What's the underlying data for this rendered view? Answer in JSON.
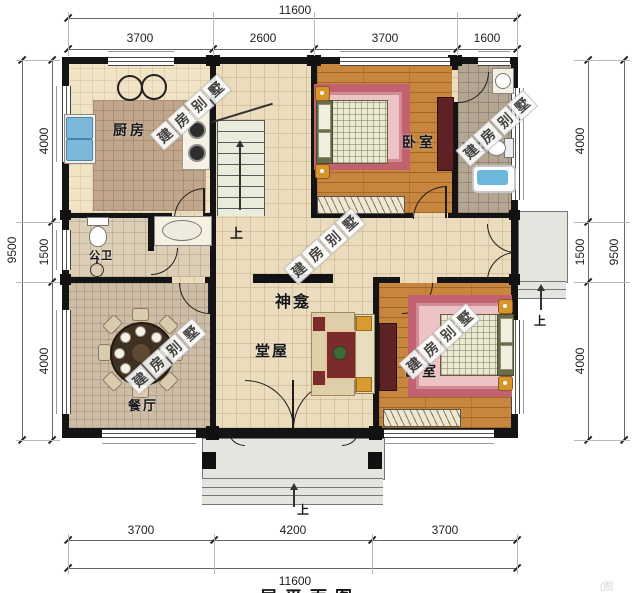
{
  "drawing": {
    "type": "floor-plan",
    "footer": {
      "partial_title": "一层平面图",
      "corner_fragment": "(图"
    }
  },
  "watermark": {
    "text": "建房别墅",
    "chars": [
      "建",
      "房",
      "别",
      "墅"
    ]
  },
  "dimensions": {
    "top": {
      "total": "11600",
      "segments": [
        "3700",
        "2600",
        "3700",
        "1600"
      ]
    },
    "bottom": {
      "total": "11600",
      "segments": [
        "3700",
        "4200",
        "3700"
      ]
    },
    "left": {
      "total": "9500",
      "segments": [
        "4000",
        "1500",
        "4000"
      ]
    },
    "right": {
      "total": "9500",
      "segments": [
        "4000",
        "1500",
        "4000"
      ]
    }
  },
  "rooms": {
    "kitchen": "厨房",
    "bedroom_top": "卧室",
    "private_bath": "私卫",
    "public_bath": "公卫",
    "dining": "餐厅",
    "hall": "堂屋",
    "shrine": "神龛",
    "bedroom_bottom": "卧室"
  },
  "labels": {
    "up": "上"
  },
  "colors": {
    "wall": "#141414",
    "floor_tile": "#eadcbd",
    "wood_floor": "#c8853d",
    "rug_pink_border": "#c2616f",
    "rug_pink_inner": "#eec3c6",
    "water_blue": "#6cb7dc",
    "maroon_furniture": "#5e2124",
    "gold_lamp": "#d7952c",
    "porch_grey": "#e3e6de",
    "watermark_tile": "#ffffff"
  }
}
